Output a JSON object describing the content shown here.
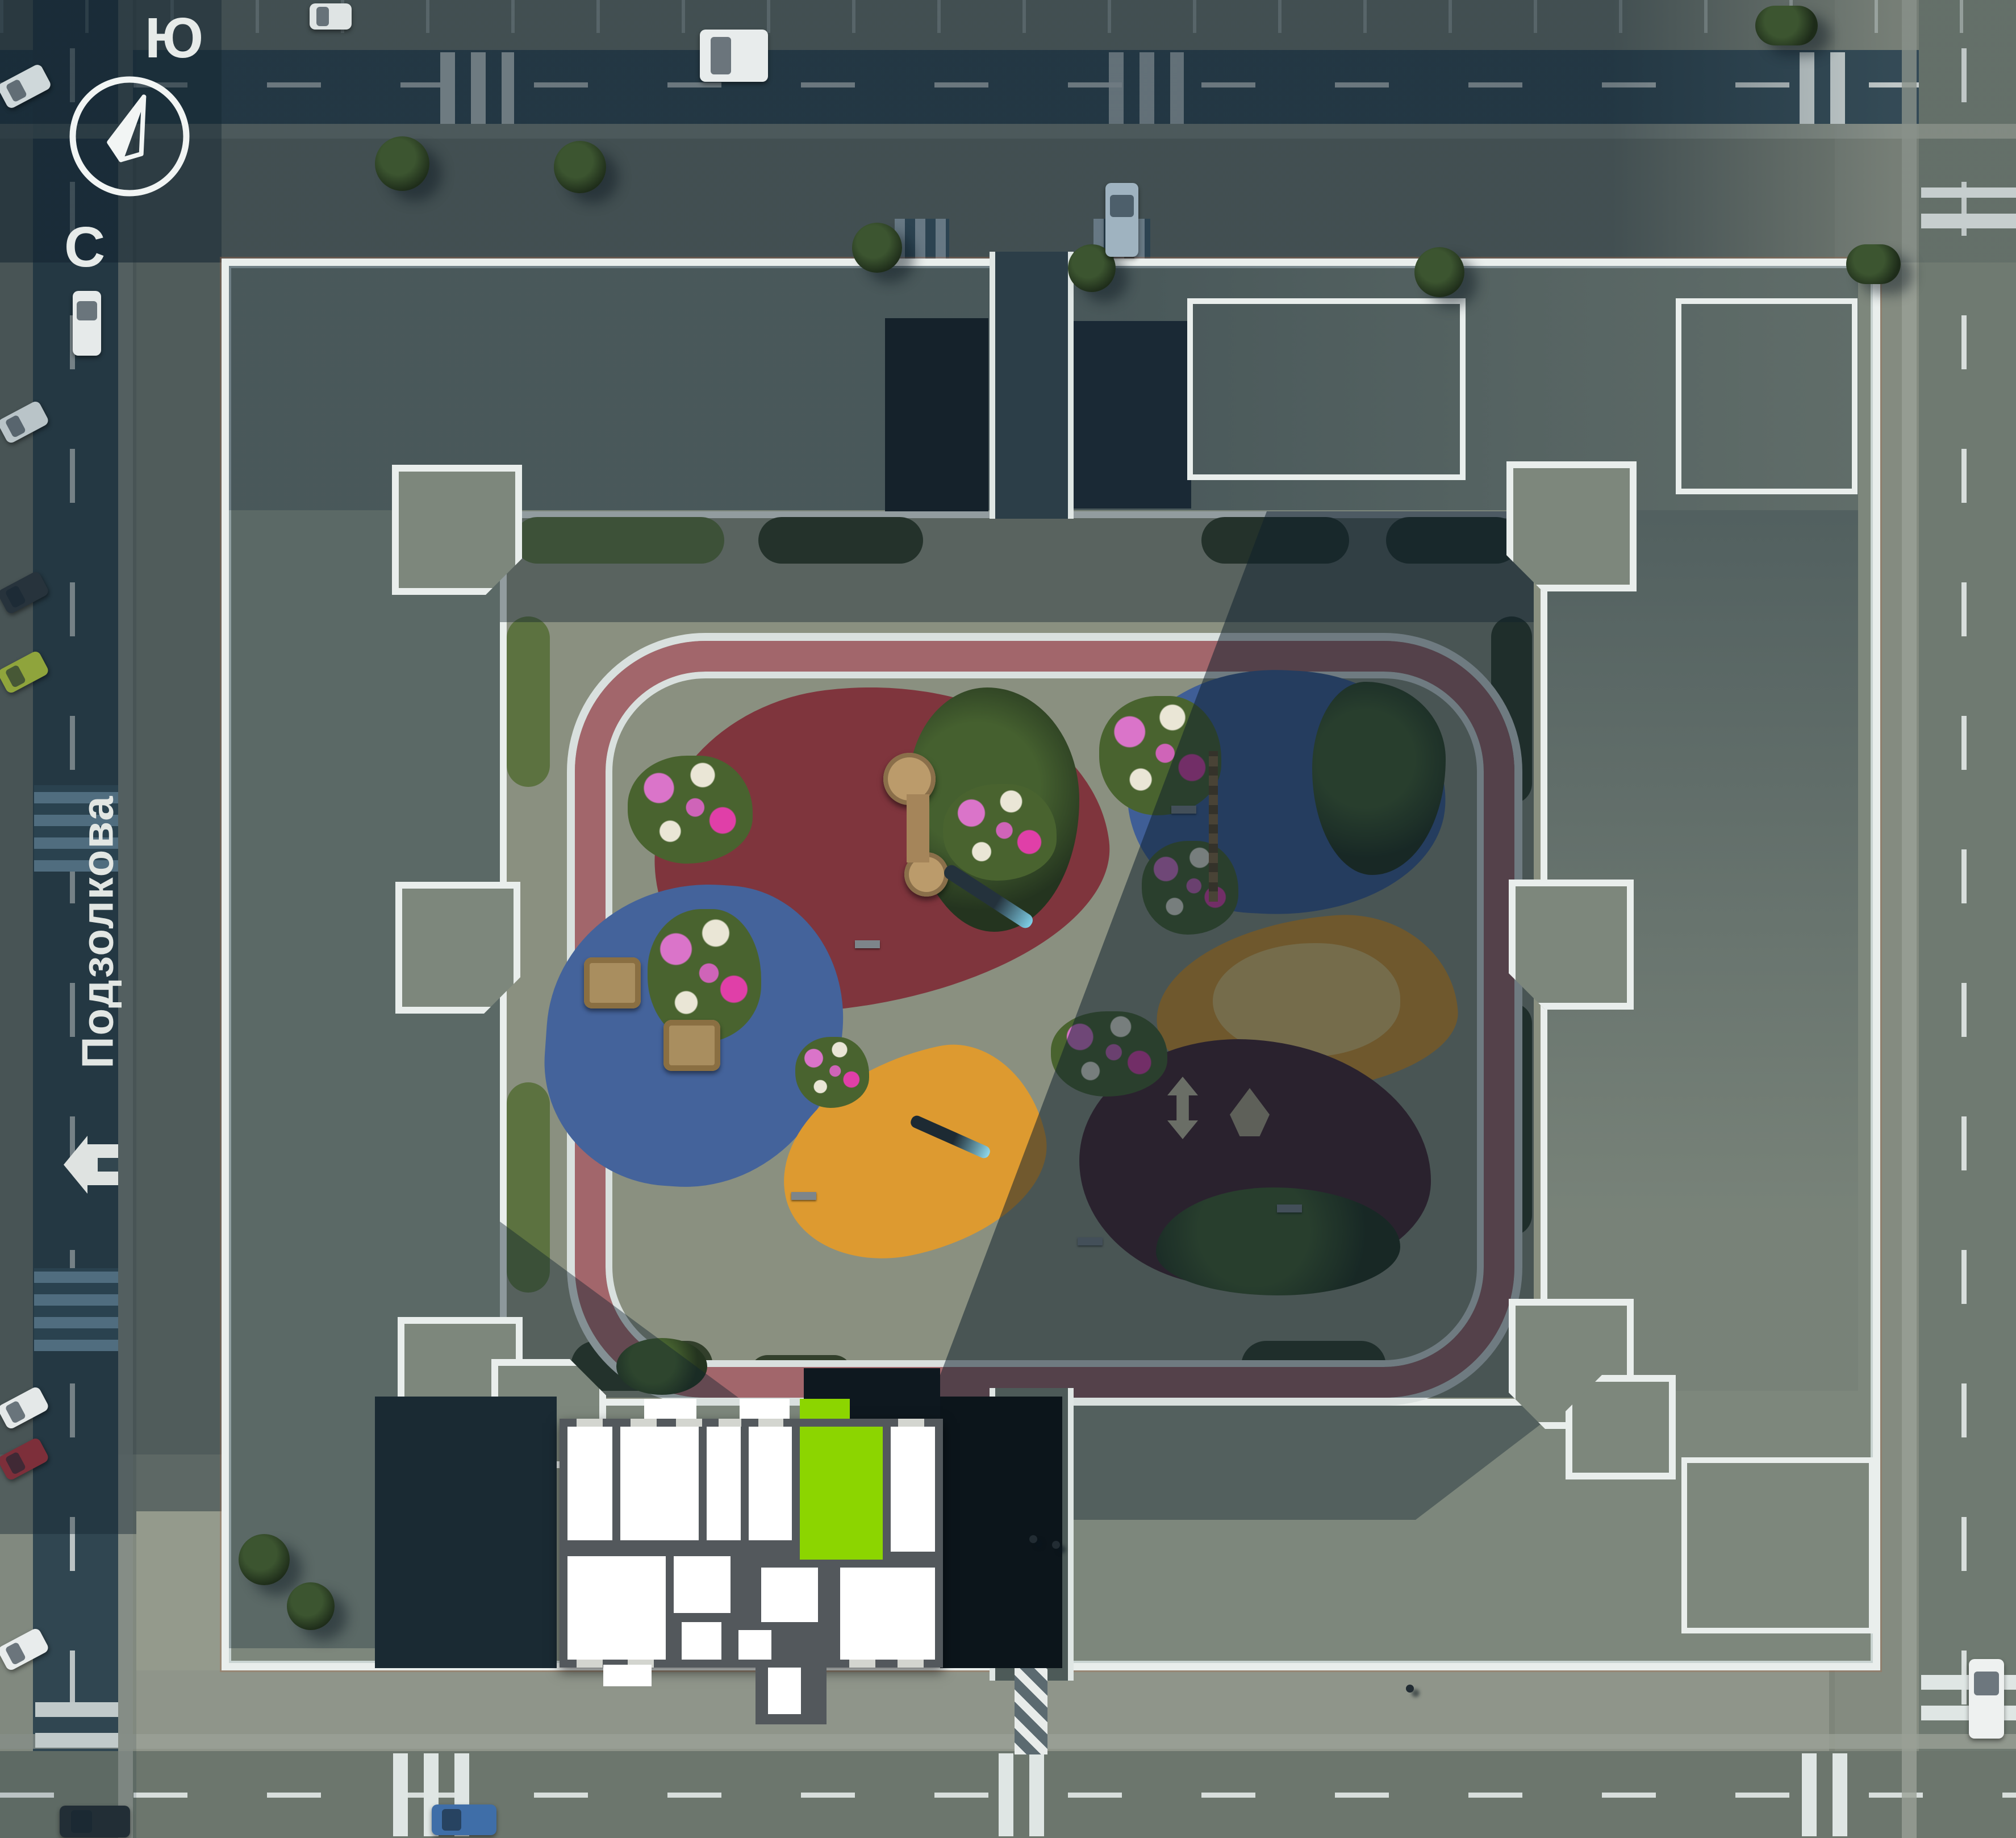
{
  "view": {
    "type": "residential-complex-site-plan",
    "description": "aerial genplan with apartment selection"
  },
  "compass": {
    "top_label": "Ю",
    "bottom_label": "С"
  },
  "street": {
    "name": "Подзолкова",
    "icon": "home-icon"
  },
  "selection": {
    "highlight_color": "#8CD500",
    "selected_unit": "apartment-on-floor-plan"
  },
  "palette": {
    "sunlit_pavement": "#7E857A",
    "shadow_teal": "#2F4450",
    "roof_grey_green": "#7D877C",
    "parapet_white": "#E9EEEC",
    "track_red": "#A2666B",
    "courtyard_pavement": "#8A9080",
    "crosswalk_white": "#DFE6E4",
    "grass_green": "#5C7240"
  },
  "playground_zones": [
    {
      "name": "kids-zone-red",
      "color": "#7F353D"
    },
    {
      "name": "play-structures-blue",
      "color": "#44639B"
    },
    {
      "name": "benches-flowers-blue",
      "color": "#3F5E96"
    },
    {
      "name": "sport-zone-orange",
      "color": "#DD9A30"
    },
    {
      "name": "slide-zone-orange",
      "color": "#DD9A30"
    },
    {
      "name": "workout-zone-dark-red",
      "color": "#4A2730"
    },
    {
      "name": "sand-pit",
      "color": "#E5C06E"
    }
  ]
}
